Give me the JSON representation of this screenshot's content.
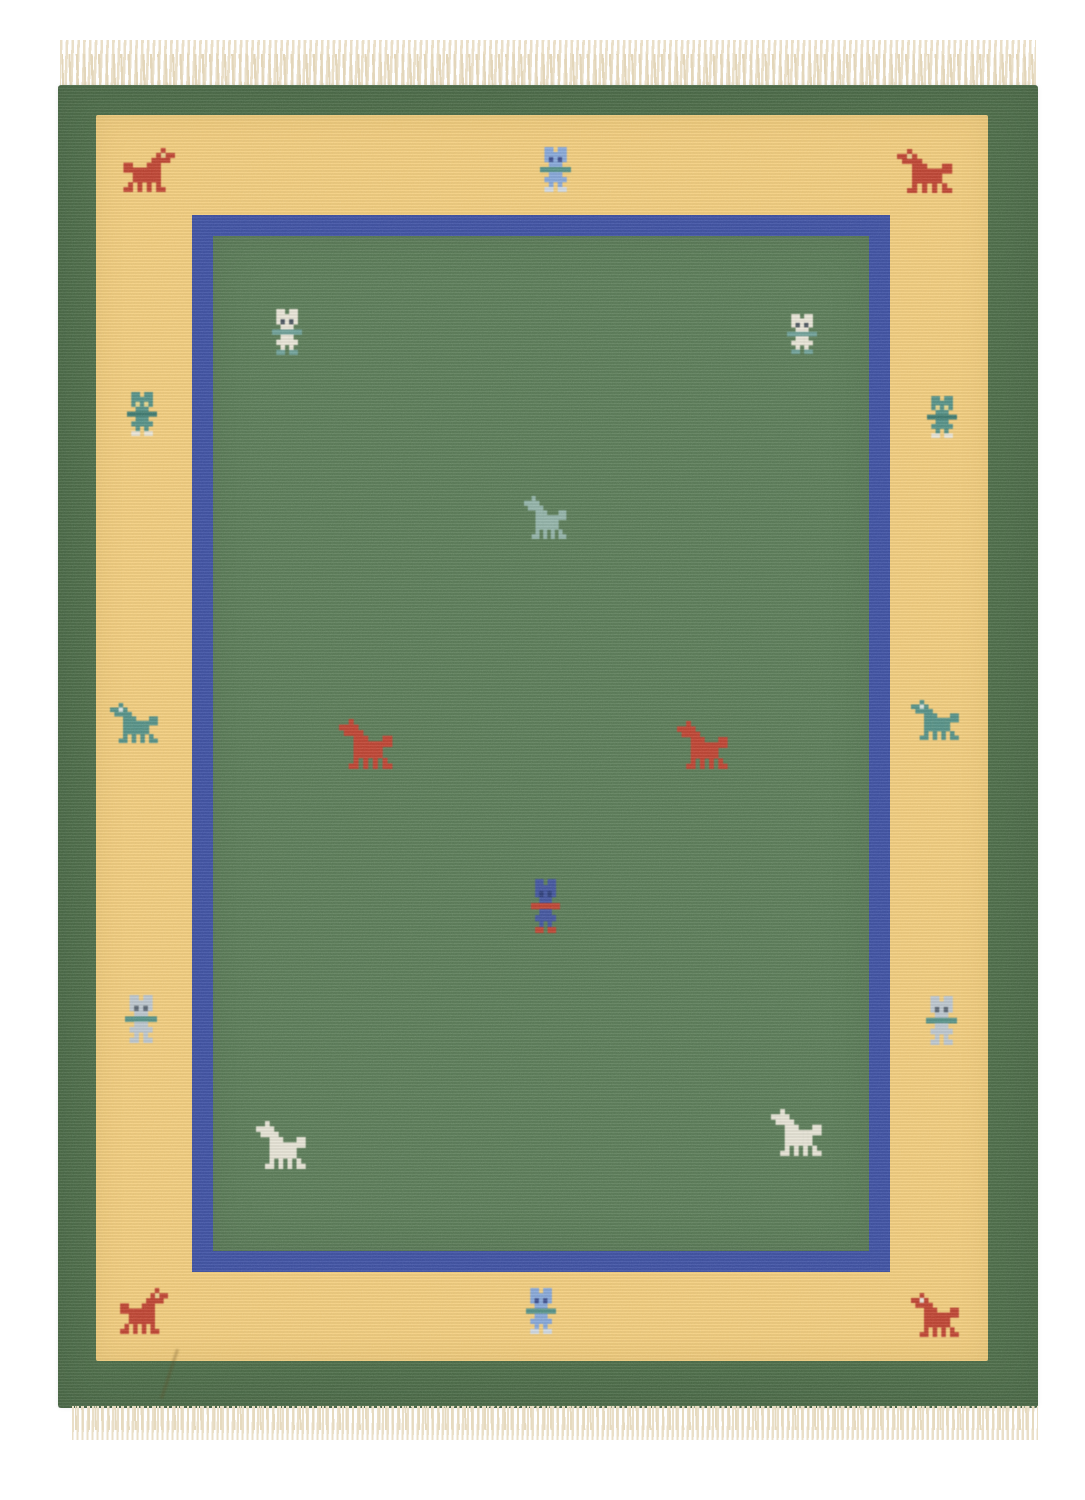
{
  "scene": {
    "type": "product-photo",
    "description": "Hand-woven wool kilim rug photographed flat on a white background, with cream fringe at top and bottom. Dark green outer border, yellow inner band decorated with small stylized horses and human figures, thin blue inner frame, and a dark green central field scattered with pixel-style horse and figure motifs.",
    "background_color": "#ffffff"
  },
  "rug": {
    "colors": {
      "outer_border_green": "#4d6d49",
      "field_green": "#5b7c58",
      "band_yellow": "#f2cd7d",
      "inner_border_blue": "#3f51a3",
      "motif_red": "#bf4433",
      "motif_teal": "#559187",
      "motif_pale_teal": "#93b3a9",
      "motif_light_blue": "#86a7d9",
      "motif_pale_gray": "#bcc6cf",
      "motif_cream": "#e9e5d7",
      "motif_dark_blue": "#44569f",
      "fringe_cream": "#eadfc8"
    },
    "pixel_maps": {
      "horse": [
        "..B.........",
        "BBEB........",
        ".BBBB.......",
        "...BBB...BB.",
        "...BBBBBBBB.",
        "...BBBBBB...",
        "...BBBBBB...",
        "...B.B.B.B..",
        "..BB.B.B.BB."
      ],
      "person": [
        ".BB.BB.",
        ".BBBBB.",
        ".BEBEB.",
        "..BBB..",
        "AAAAAAA",
        "..BBB..",
        ".BBBBB.",
        "..B.B..",
        ".FF.FF."
      ]
    },
    "motifs": [
      {
        "name": "red-horse-top-left",
        "type": "horse",
        "facing": "right",
        "x": 61,
        "y": 63,
        "w": 56,
        "h": 44,
        "body": "#bf4433",
        "eyes": "#e8cf8e"
      },
      {
        "name": "light-blue-person-top-center",
        "type": "person",
        "facing": "left",
        "x": 482,
        "y": 62,
        "w": 31,
        "h": 45,
        "body": "#86a7d9",
        "accent": "#559187",
        "feet": "#cfd8e2",
        "eyes": "#3f518f"
      },
      {
        "name": "red-horse-top-right",
        "type": "horse",
        "facing": "left",
        "x": 839,
        "y": 64,
        "w": 60,
        "h": 44,
        "body": "#bf4433",
        "eyes": "#e8cf8e"
      },
      {
        "name": "teal-person-left-upper",
        "type": "person",
        "facing": "left",
        "x": 69,
        "y": 307,
        "w": 30,
        "h": 44,
        "body": "#559187",
        "accent": "#3f7a70",
        "feet": "#e9e5d7",
        "eyes": "#e3d48b"
      },
      {
        "name": "teal-horse-left-middle",
        "type": "horse",
        "facing": "left",
        "x": 52,
        "y": 618,
        "w": 52,
        "h": 40,
        "body": "#559187",
        "eyes": "#d8e2da"
      },
      {
        "name": "gray-person-left-lower",
        "type": "person",
        "facing": "left",
        "x": 67,
        "y": 910,
        "w": 32,
        "h": 48,
        "body": "#bcc6cf",
        "accent": "#559187",
        "feet": "#bcc6cf",
        "eyes": "#5a6672"
      },
      {
        "name": "red-horse-bottom-left",
        "type": "horse",
        "facing": "right",
        "x": 58,
        "y": 1203,
        "w": 52,
        "h": 46,
        "body": "#bf4433",
        "eyes": "#e8cf8e"
      },
      {
        "name": "light-blue-person-bottom-center",
        "type": "person",
        "facing": "left",
        "x": 468,
        "y": 1203,
        "w": 30,
        "h": 46,
        "body": "#86a7d9",
        "accent": "#559187",
        "feet": "#cfd8e2",
        "eyes": "#3f518f"
      },
      {
        "name": "red-horse-bottom-right",
        "type": "horse",
        "facing": "left",
        "x": 853,
        "y": 1208,
        "w": 52,
        "h": 44,
        "body": "#bf4433",
        "eyes": "#e9e5d7"
      },
      {
        "name": "teal-person-right-upper",
        "type": "person",
        "facing": "left",
        "x": 869,
        "y": 311,
        "w": 30,
        "h": 42,
        "body": "#559187",
        "accent": "#3f7a70",
        "feet": "#e9e5d7",
        "eyes": "#e3d48b"
      },
      {
        "name": "teal-horse-right-middle",
        "type": "horse",
        "facing": "left",
        "x": 853,
        "y": 615,
        "w": 52,
        "h": 40,
        "body": "#559187",
        "eyes": "#d8e2da"
      },
      {
        "name": "gray-person-right-lower",
        "type": "person",
        "facing": "left",
        "x": 868,
        "y": 911,
        "w": 31,
        "h": 49,
        "body": "#bcc6cf",
        "accent": "#559187",
        "feet": "#bcc6cf",
        "eyes": "#5a6672"
      },
      {
        "name": "white-person-field-top-left",
        "type": "person",
        "facing": "left",
        "x": 214,
        "y": 224,
        "w": 30,
        "h": 46,
        "body": "#e9e5d7",
        "accent": "#6fa098",
        "feet": "#6fa098",
        "eyes": "#4a545e"
      },
      {
        "name": "white-person-field-top-right",
        "type": "person",
        "facing": "left",
        "x": 729,
        "y": 229,
        "w": 30,
        "h": 40,
        "body": "#e9e5d7",
        "accent": "#6fa098",
        "feet": "#6fa098",
        "eyes": "#4a545e"
      },
      {
        "name": "pale-teal-horse-field-center",
        "type": "horse",
        "facing": "left",
        "x": 466,
        "y": 411,
        "w": 46,
        "h": 43,
        "body": "#93b3a9"
      },
      {
        "name": "red-horse-field-left",
        "type": "horse",
        "facing": "left",
        "x": 281,
        "y": 634,
        "w": 58,
        "h": 50,
        "body": "#bf4433"
      },
      {
        "name": "red-horse-field-right",
        "type": "horse",
        "facing": "left",
        "x": 619,
        "y": 636,
        "w": 55,
        "h": 48,
        "body": "#bf4433"
      },
      {
        "name": "blue-person-field-center",
        "type": "person",
        "facing": "left",
        "x": 473,
        "y": 794,
        "w": 29,
        "h": 54,
        "body": "#44569f",
        "accent": "#bf4433",
        "feet": "#bf4433",
        "eyes": "#2f3f7a"
      },
      {
        "name": "white-horse-field-bottom-left",
        "type": "horse",
        "facing": "left",
        "x": 198,
        "y": 1036,
        "w": 54,
        "h": 48,
        "body": "#e6e3d5"
      },
      {
        "name": "white-horse-field-bottom-right",
        "type": "horse",
        "facing": "left",
        "x": 713,
        "y": 1024,
        "w": 55,
        "h": 47,
        "body": "#e6e3d5"
      }
    ],
    "fringe": {
      "position": "top-and-bottom",
      "color": "#eadfc8"
    }
  }
}
